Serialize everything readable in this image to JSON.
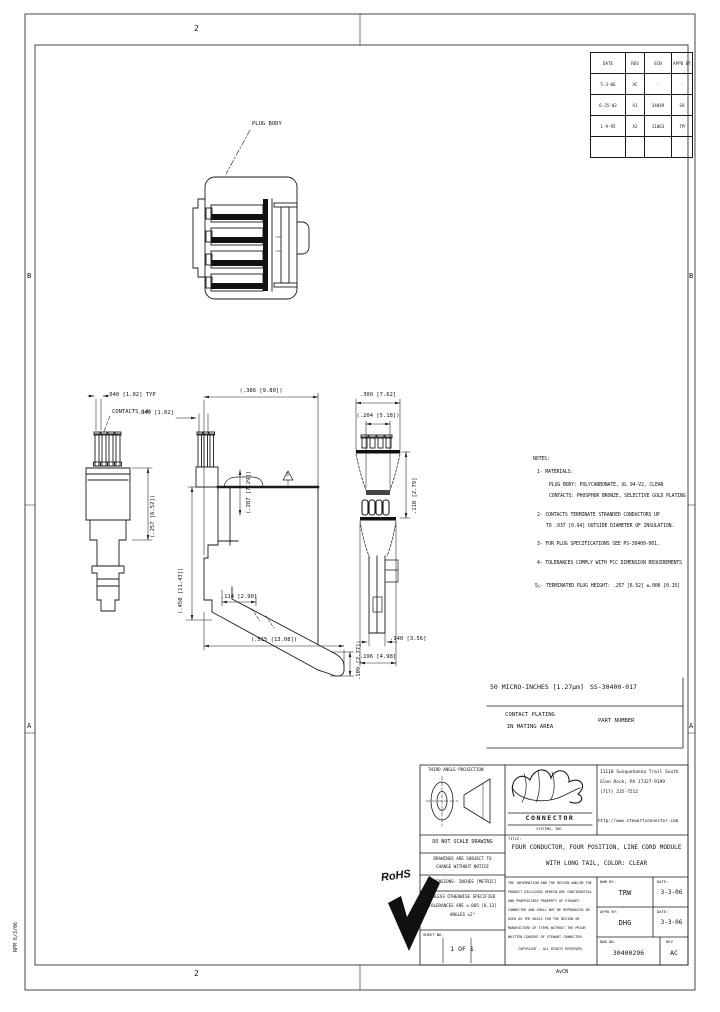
{
  "sheet": {
    "zone_top": "2",
    "zone_bottom": "2",
    "zone_b": "B",
    "zone_a": "A",
    "stamp_left": "RPM 6/3/06",
    "stamp_bottom": "AvCN"
  },
  "revision_table": {
    "headers": [
      "DATE",
      "REV",
      "ECN",
      "APPD BY"
    ],
    "rows": [
      [
        "5-3-06",
        "AC",
        "-",
        "-"
      ],
      [
        "6-25-02",
        "A1",
        "34049",
        "SA"
      ],
      [
        "1-9-95",
        "A2",
        "11063",
        "TM"
      ]
    ]
  },
  "views": {
    "front_label": "PLUG BODY",
    "dims": {
      "lv_pitch": ".040 [1.02] TYP",
      "lv_contacts": "CONTACTS (4)",
      "lv_height": "(.257 [6.52])",
      "mv_pin": ".040 [1.02]",
      "mv_width": "(.386 [9.80])",
      "mv_flag": "5",
      "mv_upper": "(.287 [7.29])",
      "mv_left": "(.450 [11.43])",
      "mv_tab": ".114 [2.90]",
      "mv_span": "(.515 [13.08])",
      "mv_tail": ".109 [2.77]",
      "rv_width": ".300 [7.62]",
      "rv_inner": "(.204 [5.18])",
      "rv_height": ".110 [2.79]",
      "rv_foot": ".140 [3.56]",
      "rv_base": ".196 [4.98]"
    }
  },
  "notes": {
    "heading": "NOTES:",
    "n1": "1- MATERIALS:",
    "n1a": "PLUG BODY:  POLYCARBONATE, UL 94-V2, CLEAR",
    "n1b": "CONTACTS:  PHOSPHOR BRONZE, SELECTIVE GOLD PLATING",
    "n2": "2- CONTACTS TERMINATE STRANDED CONDUCTORS UP",
    "n2a": "TO .037 [0.94] OUTSIDE DIAMETER OF INSULATION.",
    "n3": "3- FOR PLUG SPECIFICATIONS SEE PS-30400-001.",
    "n4": "4- TOLERANCES COMPLY WITH FCC DIMENSION REQUIREMENTS",
    "n5": "5△- TERMINATED PLUG HEIGHT:  .257 [6.52] ±.006 [0.15]"
  },
  "plating_table": {
    "plating_value": "50 MICRO-INCHES [1.27μm]",
    "part_number": "SS-30400-017",
    "plating_label1": "CONTACT PLATING",
    "plating_label2": "IN MATING AREA",
    "part_label": "PART NUMBER"
  },
  "title_block": {
    "projection": "THIRD ANGLE PROJECTION",
    "logo_name": "CONNECTOR",
    "logo_sub": "SYSTEMS, INC.",
    "address1": "11118 Susquehanna Trail South",
    "address2": "Glen Rock, PA 17327-9199",
    "address3": "(717) 235-7512",
    "website": "http://www.stewartconnector.com",
    "do_not_scale": "DO NOT SCALE DRAWING",
    "subject1": "DRAWINGS ARE SUBJECT TO",
    "subject2": "CHANGE WITHOUT NOTICE",
    "title_label": "TITLE:",
    "title1": "FOUR CONDUCTOR, FOUR POSITION, LINE CORD MODULE",
    "title2": "WITH LONG TAIL, COLOR: CLEAR",
    "dims_note": "DIMENSIONS: INCHES [METRIC]",
    "tol1": "UNLESS OTHERWISE SPECIFIED",
    "tol2": "TOLERANCES ARE ±.005 [0.13]",
    "tol3": "ANGLES ±2°",
    "sheet_label": "SHEET NO.",
    "sheet_value": "1 OF 1",
    "legal": [
      "THE INFORMATION AND THE DESIGN AND/OR THE",
      "PRODUCT DISCLOSED HEREIN ARE CONFIDENTIAL",
      "AND PROPRIETARY PROPERTY OF STEWART",
      "CONNECTOR AND SHALL NOT BE REPRODUCED OR",
      "USED AS THE BASIS FOR THE DESIGN OR",
      "MANUFACTURE OF ITEMS WITHOUT THE PRIOR",
      "WRITTEN CONSENT OF STEWART CONNECTOR.",
      "COPYRIGHT - ALL RIGHTS RESERVED"
    ],
    "dwn_label": "DWN BY:",
    "dwn": "TRW",
    "date_label": "DATE:",
    "date1": "3-3-06",
    "appd_label": "APPD BY:",
    "appd": "DHG",
    "date2": "3-3-06",
    "dwg_label": "DWG NO.",
    "dwg_no": "30400296",
    "rev_label": "REV",
    "rev": "AC"
  },
  "rohs_label": "RoHS"
}
